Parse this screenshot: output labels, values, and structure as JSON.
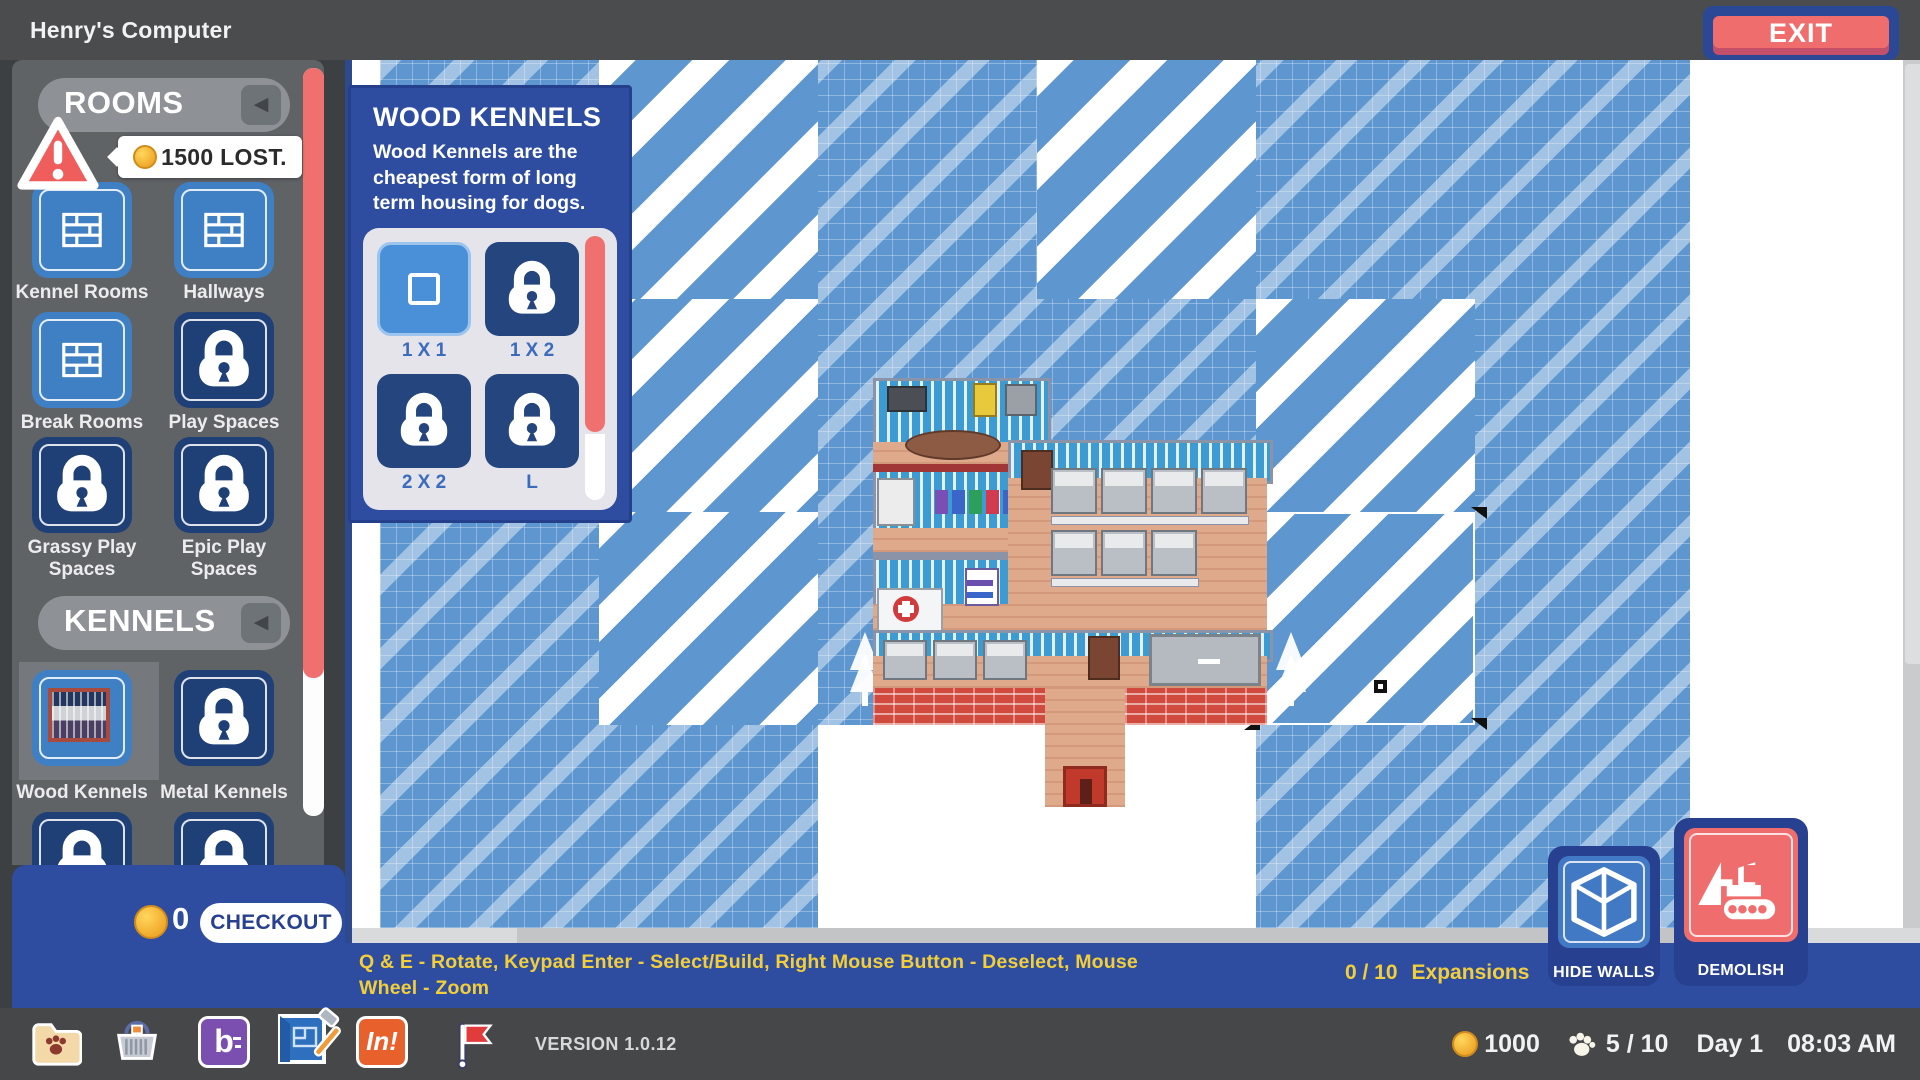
{
  "top_bar": {
    "title": "Henry's Computer",
    "exit_label": "EXIT"
  },
  "sidebar": {
    "rooms_header": "ROOMS",
    "kennels_header": "KENNELS",
    "warning_tooltip": "1500 LOST.",
    "rooms": [
      {
        "label": "Kennel Rooms",
        "locked": false
      },
      {
        "label": "Hallways",
        "locked": false
      },
      {
        "label": "Break Rooms",
        "locked": false
      },
      {
        "label": "Play Spaces",
        "locked": true
      },
      {
        "label": "Grassy Play Spaces",
        "locked": true
      },
      {
        "label": "Epic Play Spaces",
        "locked": true
      }
    ],
    "kennels": [
      {
        "label": "Wood Kennels",
        "locked": false,
        "selected": true
      },
      {
        "label": "Metal Kennels",
        "locked": true
      }
    ]
  },
  "popup": {
    "title": "WOOD KENNELS",
    "description": "Wood Kennels are the cheapest form of long term housing for dogs.",
    "sizes": [
      {
        "label": "1 X 1",
        "locked": false,
        "selected": true
      },
      {
        "label": "1 X 2",
        "locked": true
      },
      {
        "label": "2 X 2",
        "locked": true
      },
      {
        "label": "L",
        "locked": true
      }
    ]
  },
  "footer": {
    "cart_total": "0",
    "checkout_label": "CHECKOUT"
  },
  "instruction_bar": {
    "text": "Q & E  - Rotate,  Keypad Enter  - Select/Build,  Right Mouse Button  - Deselect, Mouse Wheel - Zoom",
    "expansions_count": "0 / 10",
    "expansions_label": "Expansions"
  },
  "tools": {
    "hide_walls_label": "HIDE WALLS",
    "demolish_label": "DEMOLISH"
  },
  "taskbar": {
    "version": "VERSION 1.0.12",
    "b_app_glyph": "b",
    "in_app_glyph": "In!",
    "status": {
      "coins": "1000",
      "dogs": "5 / 10",
      "day": "Day 1",
      "time": "08:03 AM"
    }
  },
  "colors": {
    "accent_blue": "#2e4da0",
    "salmon": "#ef6d6d",
    "map_blue": "#5e97d0",
    "hint_yellow": "#f2cf3a",
    "coin_gold": "#f0a92a",
    "locked_navy": "#1f3f77"
  }
}
